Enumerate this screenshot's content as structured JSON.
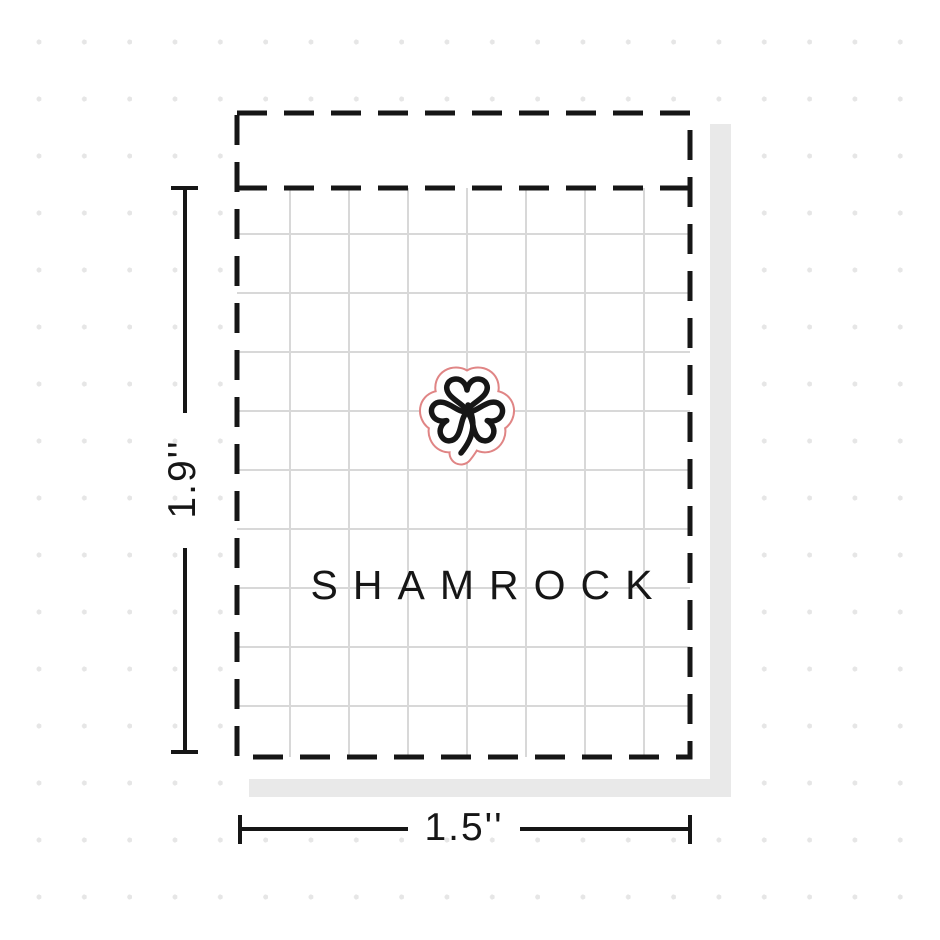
{
  "diagram": {
    "type": "sticker-packaging-size-diagram",
    "sticker_name": "SHAMROCK",
    "height_label": "1.9''",
    "width_label": "1.5''",
    "icon": "shamrock-icon"
  },
  "colors": {
    "line_black": "#161616",
    "grid_gray": "#d8d8d8",
    "die_cut_red": "#e08585",
    "shadow_gray": "#e9e9e9",
    "dot_gray": "#e6e6e6",
    "background": "#ffffff"
  }
}
